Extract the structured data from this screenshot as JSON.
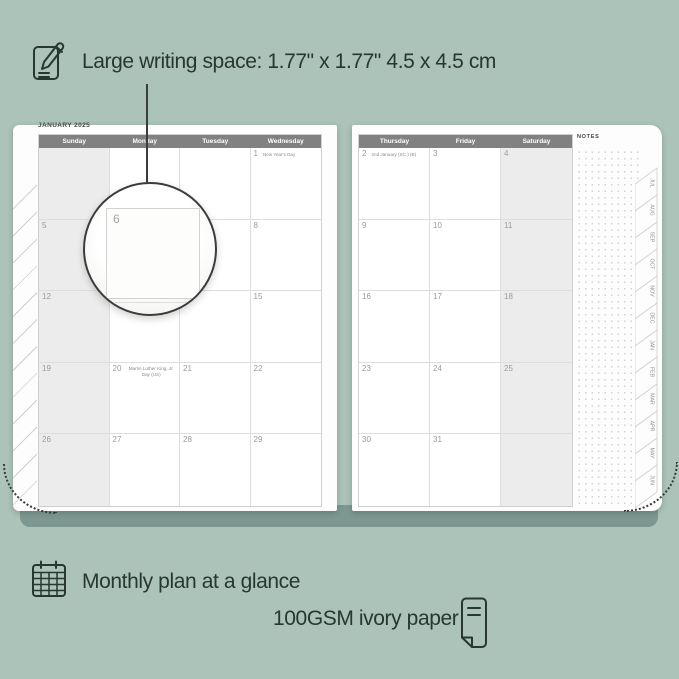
{
  "colors": {
    "background": "#abc3b9",
    "caption_text": "#28372f",
    "book_band": "#7d9890",
    "header_bar": "#818181",
    "shaded_column": "#ececec",
    "grid_line": "#dedede",
    "day_number": "#9a9a9a"
  },
  "captions": {
    "top": "Large writing space: 1.77\" x 1.77\" 4.5 x 4.5 cm",
    "bottom_left": "Monthly plan at a glance",
    "bottom_right": "100GSM ivory paper"
  },
  "planner": {
    "title": "JANUARY 2025",
    "notes_label": "NOTES",
    "left_headers": [
      "Sunday",
      "Monday",
      "Tuesday",
      "Wednesday"
    ],
    "right_headers": [
      "Thursday",
      "Friday",
      "Saturday"
    ],
    "left_rows": [
      [
        "",
        "",
        "",
        {
          "n": "1",
          "note": "New Year's Day"
        }
      ],
      [
        "5",
        "6",
        "7",
        "8"
      ],
      [
        "12",
        "13",
        "14",
        "15"
      ],
      [
        "19",
        {
          "n": "20",
          "note": "Martin Luther King, Jr. Day (US)"
        },
        "21",
        "22"
      ],
      [
        "26",
        "27",
        "28",
        "29"
      ]
    ],
    "right_rows": [
      [
        {
          "n": "2",
          "note": "2nd January (SC.) (B)"
        },
        "3",
        "4"
      ],
      [
        "9",
        "10",
        "11"
      ],
      [
        "16",
        "17",
        "18"
      ],
      [
        "23",
        "24",
        "25"
      ],
      [
        "30",
        "31",
        ""
      ]
    ],
    "month_tabs": [
      "JUL",
      "AUG",
      "SEP",
      "OCT",
      "NOV",
      "DEC",
      "JAN",
      "FEB",
      "MAR",
      "APR",
      "MAY",
      "JUN"
    ],
    "magnifier_day": "6"
  }
}
